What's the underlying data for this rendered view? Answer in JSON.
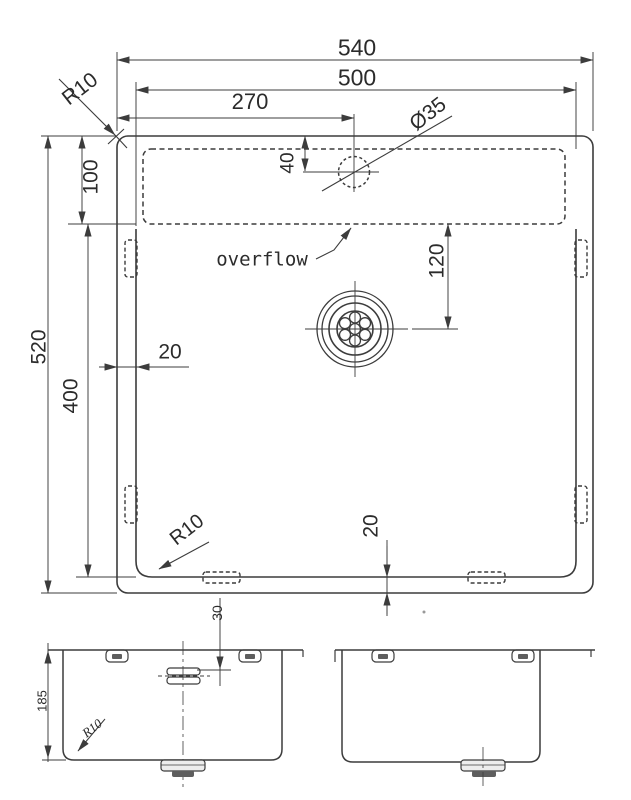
{
  "document": {
    "type": "technical-dimension-drawing",
    "subject": "undermount kitchen sink, top view with front and side sections"
  },
  "colors": {
    "background": "#ffffff",
    "line": "#3c3c3c",
    "text": "#2b2b2b",
    "drain_fill": "#ededed",
    "drain_dark": "#5e5e5e"
  },
  "views": {
    "top": {
      "name": "top view",
      "dimensions": {
        "overall_width": "540",
        "bowl_width": "500",
        "faucet_center_offset": "270",
        "rim_corner_radius": "R10",
        "faucet_hole_diameter": "Ø35",
        "deck_depth": "100",
        "faucet_hole_from_rim": "40",
        "overflow_label": "overflow",
        "drain_center_from_overflow": "120",
        "side_rim_width": "20",
        "overall_depth": "520",
        "bowl_depth": "400",
        "bowl_corner_radius": "R10",
        "bottom_rim_width": "20"
      }
    },
    "front": {
      "name": "front section view",
      "dimensions": {
        "overflow_from_rim": "30",
        "bowl_inner_height": "185",
        "bottom_corner_radius": "R10"
      }
    },
    "side": {
      "name": "side section view"
    }
  }
}
